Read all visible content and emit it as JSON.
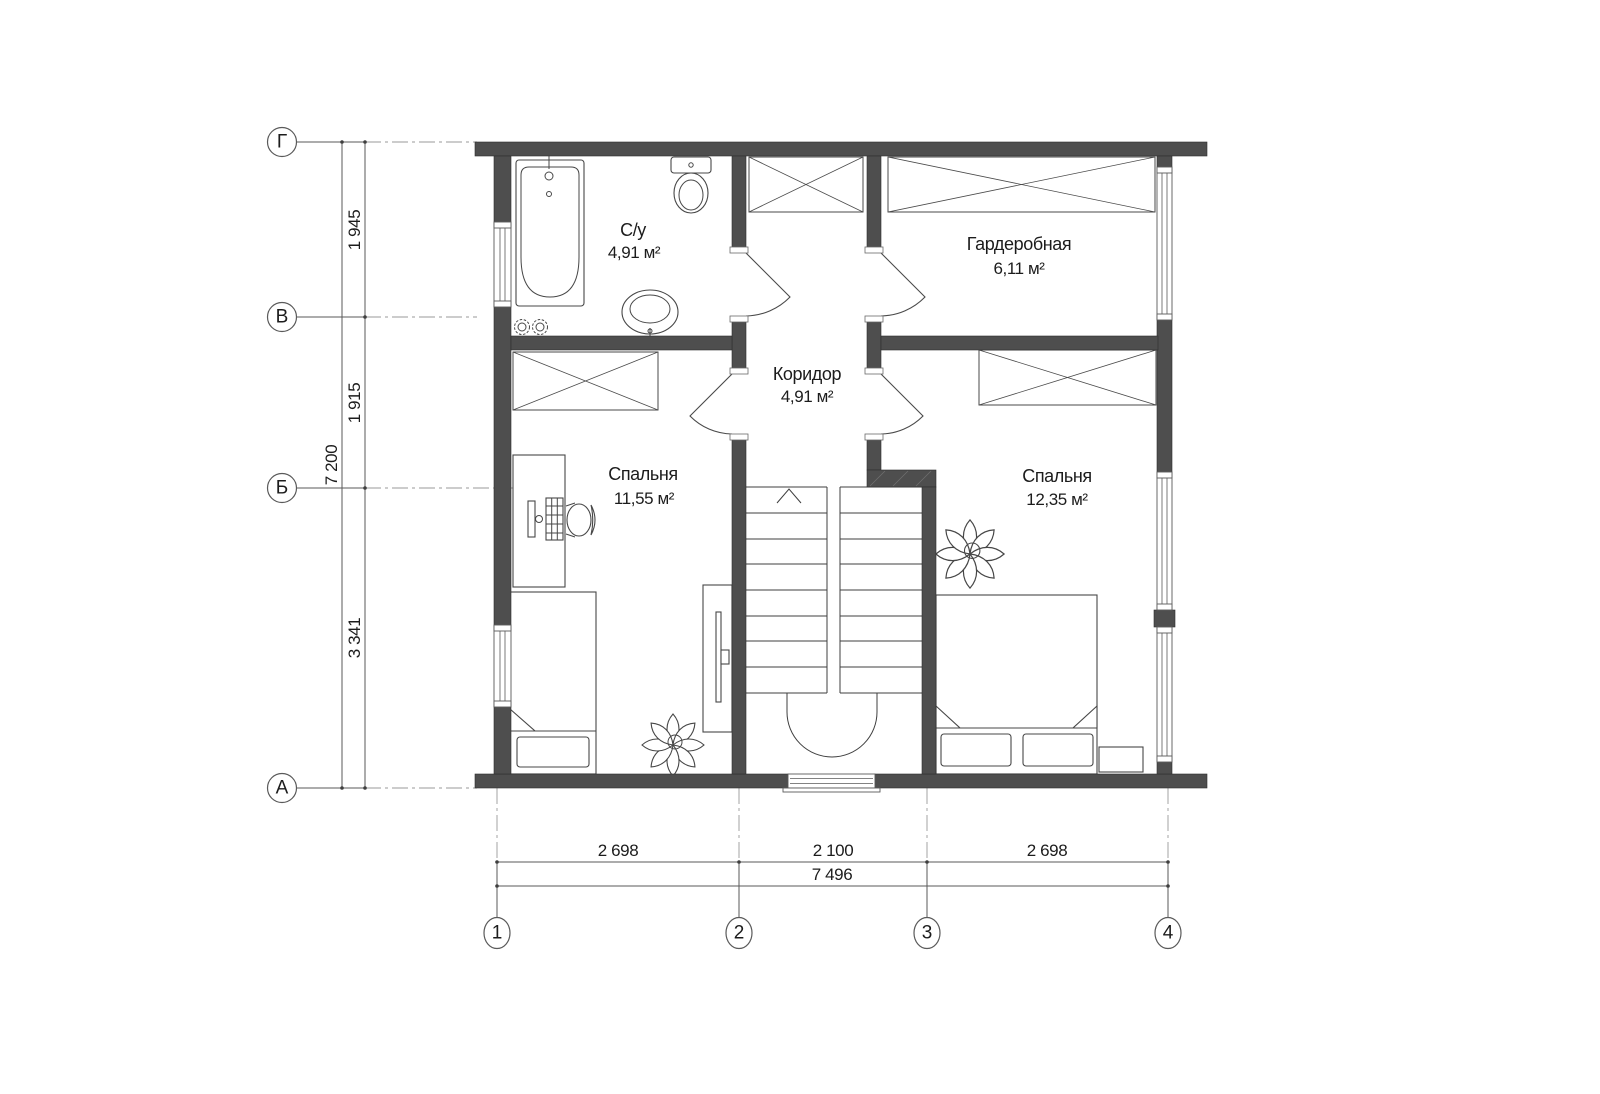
{
  "floor_plan": {
    "rooms": [
      {
        "name": "С/у",
        "area": "4,91 м²"
      },
      {
        "name": "Гардеробная",
        "area": "6,11 м²"
      },
      {
        "name": "Коридор",
        "area": "4,91 м²"
      },
      {
        "name": "Спальня",
        "area": "11,55 м²"
      },
      {
        "name": "Спальня",
        "area": "12,35 м²"
      }
    ],
    "grid": {
      "row_labels": [
        "Г",
        "В",
        "Б",
        "А"
      ],
      "col_labels": [
        "1",
        "2",
        "3",
        "4"
      ]
    },
    "dimensions": {
      "left": {
        "segments": [
          "1 945",
          "1 915",
          "3 341"
        ],
        "total": "7 200"
      },
      "bottom": {
        "segments": [
          "2 698",
          "2 100",
          "2 698"
        ],
        "total": "7 496"
      }
    },
    "colors": {
      "wall": "#4e4e4e",
      "furniture_line": "#474747",
      "dimension_line": "#5a5a5a",
      "axis_line": "#9a9a9a",
      "text": "#1c1c1c",
      "background": "#ffffff"
    }
  }
}
